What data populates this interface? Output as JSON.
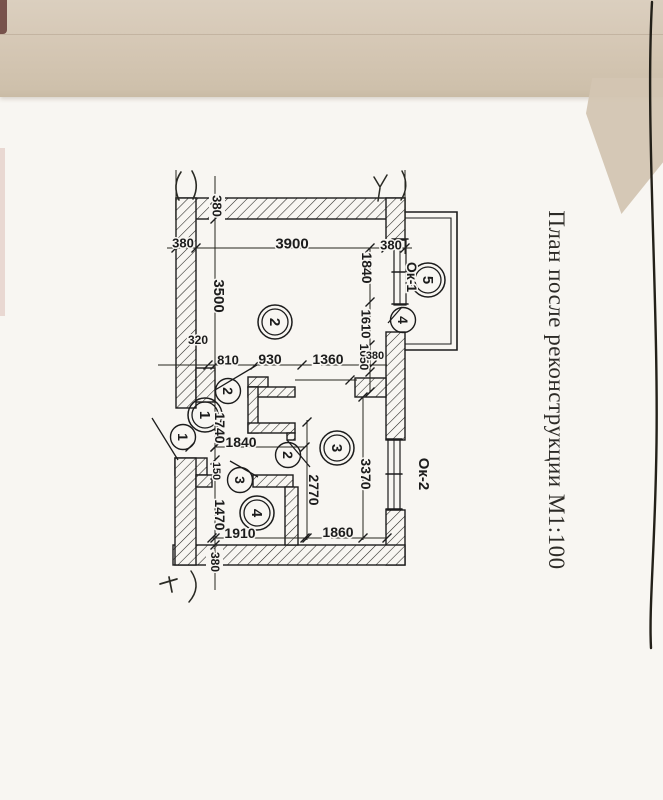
{
  "document": {
    "title": "План после реконструкции М1:100"
  },
  "colors": {
    "ink": "#1c1c1c",
    "paper": "#f8f6f2",
    "band": "#d4c6b3",
    "pencil": "#2a2a24",
    "edge_line": "#232019"
  },
  "plan": {
    "room_markers": [
      {
        "num": "1",
        "x": 205,
        "y": 415
      },
      {
        "num": "2",
        "x": 275,
        "y": 322
      },
      {
        "num": "3",
        "x": 337,
        "y": 448
      },
      {
        "num": "4",
        "x": 257,
        "y": 513
      },
      {
        "num": "5",
        "x": 428,
        "y": 280
      }
    ],
    "door_markers": [
      {
        "num": "1",
        "x": 183,
        "y": 437
      },
      {
        "num": "2",
        "x": 228,
        "y": 391
      },
      {
        "num": "2",
        "x": 288,
        "y": 455
      },
      {
        "num": "3",
        "x": 240,
        "y": 480
      },
      {
        "num": "4",
        "x": 403,
        "y": 320
      }
    ],
    "window_labels": [
      {
        "text": "Ок-1",
        "x": 412,
        "y": 277,
        "rot": 90,
        "size": 14
      },
      {
        "text": "Ок-2",
        "x": 424,
        "y": 474,
        "rot": 90,
        "size": 15
      }
    ],
    "dim_labels": [
      {
        "text": "380",
        "x": 183,
        "y": 243,
        "rot": 0,
        "size": 13
      },
      {
        "text": "3900",
        "x": 292,
        "y": 243,
        "rot": 0,
        "size": 15
      },
      {
        "text": "380",
        "x": 391,
        "y": 245,
        "rot": 0,
        "size": 13
      },
      {
        "text": "380",
        "x": 217,
        "y": 206,
        "rot": 90,
        "size": 13
      },
      {
        "text": "3500",
        "x": 219,
        "y": 296,
        "rot": 90,
        "size": 15
      },
      {
        "text": "320",
        "x": 198,
        "y": 340,
        "rot": 0,
        "size": 12
      },
      {
        "text": "810",
        "x": 228,
        "y": 360,
        "rot": 0,
        "size": 13
      },
      {
        "text": "930",
        "x": 270,
        "y": 359,
        "rot": 0,
        "size": 14
      },
      {
        "text": "1360",
        "x": 328,
        "y": 359,
        "rot": 0,
        "size": 14
      },
      {
        "text": "1840",
        "x": 367,
        "y": 268,
        "rot": 90,
        "size": 14
      },
      {
        "text": "1610",
        "x": 366,
        "y": 324,
        "rot": 90,
        "size": 13
      },
      {
        "text": "1050",
        "x": 364,
        "y": 357,
        "rot": 90,
        "size": 12
      },
      {
        "text": "380",
        "x": 375,
        "y": 355,
        "rot": 0,
        "size": 11
      },
      {
        "text": "1740",
        "x": 220,
        "y": 428,
        "rot": 90,
        "size": 14
      },
      {
        "text": "1840",
        "x": 241,
        "y": 442,
        "rot": 0,
        "size": 14
      },
      {
        "text": "150",
        "x": 217,
        "y": 471,
        "rot": 90,
        "size": 11
      },
      {
        "text": "1470",
        "x": 220,
        "y": 515,
        "rot": 90,
        "size": 14
      },
      {
        "text": "1910",
        "x": 240,
        "y": 533,
        "rot": 0,
        "size": 14
      },
      {
        "text": "1860",
        "x": 338,
        "y": 532,
        "rot": 0,
        "size": 14
      },
      {
        "text": "2770",
        "x": 314,
        "y": 490,
        "rot": 90,
        "size": 14
      },
      {
        "text": "3370",
        "x": 366,
        "y": 474,
        "rot": 90,
        "size": 14
      },
      {
        "text": "380",
        "x": 215,
        "y": 562,
        "rot": 90,
        "size": 12
      }
    ],
    "geometry": {
      "walls": [
        [
          176,
          198,
          229,
          21
        ],
        [
          176,
          198,
          20,
          210
        ],
        [
          386,
          198,
          19,
          42
        ],
        [
          386,
          332,
          19,
          108
        ],
        [
          386,
          510,
          19,
          55
        ],
        [
          173,
          545,
          232,
          20
        ],
        [
          175,
          458,
          32,
          17
        ],
        [
          175,
          458,
          21,
          107
        ],
        [
          196,
          475,
          16,
          12
        ],
        [
          196,
          368,
          19,
          34
        ],
        [
          355,
          378,
          31,
          19
        ],
        [
          248,
          377,
          20,
          10
        ],
        [
          248,
          387,
          47,
          10
        ],
        [
          248,
          387,
          10,
          46
        ],
        [
          248,
          423,
          47,
          10
        ],
        [
          287,
          433,
          8,
          7
        ],
        [
          253,
          475,
          40,
          12
        ],
        [
          285,
          487,
          13,
          58
        ]
      ],
      "masks": [
        [
          209,
          195,
          16,
          25
        ],
        [
          206,
          549,
          17,
          17
        ],
        [
          381,
          239,
          21,
          13
        ]
      ],
      "lines": [
        [
          167,
          248,
          412,
          248,
          1
        ],
        [
          215,
          176,
          215,
          590,
          1
        ],
        [
          370,
          248,
          370,
          392,
          1
        ],
        [
          363,
          397,
          363,
          540,
          1
        ],
        [
          158,
          365,
          387,
          365,
          1
        ],
        [
          215,
          447,
          305,
          447,
          1
        ],
        [
          212,
          538,
          387,
          538,
          1
        ],
        [
          307,
          420,
          307,
          540,
          1
        ],
        [
          176,
          170,
          176,
          254,
          1
        ],
        [
          405,
          170,
          405,
          254,
          1
        ],
        [
          295,
          380,
          357,
          380,
          1
        ]
      ],
      "ticks": [
        [
          176,
          248
        ],
        [
          196,
          248
        ],
        [
          386,
          248
        ],
        [
          405,
          248
        ],
        [
          208,
          365
        ],
        [
          255,
          365
        ],
        [
          302,
          365
        ],
        [
          372,
          365
        ],
        [
          215,
          200
        ],
        [
          215,
          219
        ],
        [
          215,
          365
        ],
        [
          215,
          447
        ],
        [
          215,
          460
        ],
        [
          215,
          475
        ],
        [
          215,
          538
        ],
        [
          215,
          545
        ],
        [
          215,
          565
        ],
        [
          370,
          248
        ],
        [
          370,
          302
        ],
        [
          370,
          345
        ],
        [
          370,
          372
        ],
        [
          370,
          392
        ],
        [
          363,
          397
        ],
        [
          363,
          538
        ],
        [
          307,
          422
        ],
        [
          307,
          538
        ],
        [
          215,
          447
        ],
        [
          305,
          447
        ],
        [
          212,
          538
        ],
        [
          305,
          538
        ],
        [
          387,
          538
        ],
        [
          350,
          380
        ],
        [
          190,
          447
        ]
      ],
      "leaves": [
        [
          152,
          418,
          178,
          460
        ],
        [
          215,
          390,
          257,
          365
        ],
        [
          287,
          440,
          310,
          467
        ],
        [
          230,
          461,
          258,
          477
        ],
        [
          388,
          323,
          402,
          307
        ]
      ],
      "paths": [
        {
          "d": "M405,212H457V350H405",
          "w": 1.6
        },
        {
          "d": "M405,218H451V344H405",
          "w": 1.1
        },
        {
          "d": "M394,240h12v65h-12z",
          "w": 1.2
        },
        {
          "d": "M400,240v65",
          "w": 1
        },
        {
          "d": "M392,239h16M392,272h16M392,304h16",
          "w": 1.6
        },
        {
          "d": "M388,440h12v70h-12z",
          "w": 1.2
        },
        {
          "d": "M394,440v70",
          "w": 1
        },
        {
          "d": "M386,439h16M386,474h16M386,509h16",
          "w": 1.6
        },
        {
          "d": "M181,172q-9,13,-2,28",
          "w": 1.6,
          "c": "#2a2a24"
        },
        {
          "d": "M192,171q8,14,1,28",
          "w": 1.6,
          "c": "#2a2a24"
        },
        {
          "d": "M374,177l6,10l7,-12",
          "w": 1.5,
          "c": "#2a2a24"
        },
        {
          "d": "M380,188l-2,13",
          "w": 1.5,
          "c": "#2a2a24"
        },
        {
          "d": "M402,171q8,15,-1,29",
          "w": 1.5,
          "c": "#2a2a24"
        },
        {
          "d": "M160,584l17,-5",
          "w": 1.7,
          "c": "#2a2a24"
        },
        {
          "d": "M169,577l3,15",
          "w": 1.7,
          "c": "#2a2a24"
        },
        {
          "d": "M191,571q11,16,-2,31",
          "w": 1.5,
          "c": "#2a2a24"
        },
        {
          "d": "M652,2c-7,128,8,318,4,468c-2,90,-7,140,-5,178",
          "w": 2.4,
          "c": "#232019"
        }
      ]
    }
  }
}
